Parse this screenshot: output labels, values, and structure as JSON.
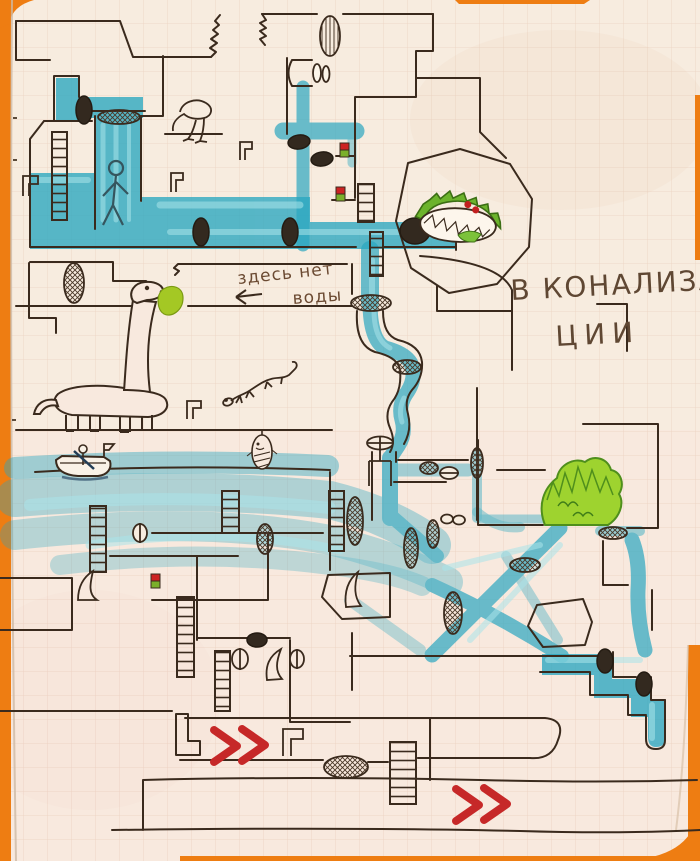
{
  "scene": {
    "type": "hand-drawn sewer level map",
    "medium": "ink and teal marker on squared notebook paper",
    "page": "graph-paper notebook with orange cover edges"
  },
  "labels": {
    "no_water": {
      "line1": "здесь нет",
      "line2": "воды"
    },
    "location": {
      "line1": "В КОНАЛИЗА-",
      "line2": "ЦИИ"
    }
  },
  "palette": {
    "paper": "#f7ecdf",
    "grid": "#dcae96",
    "ink": "#3a2a1d",
    "pencil": "#5f4733",
    "water": "#2aa7c0",
    "water_light": "#a9e3e9",
    "cover_orange": "#ee7d12",
    "accent_red": "#c62828",
    "plant_green": "#9ed32f",
    "croc_green": "#6cb32c"
  },
  "elements": [
    {
      "name": "waterfall-room",
      "desc": "flooded room with ladder, waterfall and person"
    },
    {
      "name": "dinosaur",
      "desc": "long-necked dinosaur eating a green leaf"
    },
    {
      "name": "crocodile",
      "desc": "green toothy monster inside octagonal chamber"
    },
    {
      "name": "bird",
      "desc": "small long-legged bird on a ledge"
    },
    {
      "name": "lizard",
      "desc": "small lizard"
    },
    {
      "name": "boat",
      "desc": "rowing boat with paddler on water channel"
    },
    {
      "name": "bush",
      "desc": "green spiky bush on ledge"
    },
    {
      "name": "grates",
      "desc": "hatched and dark oval sewer grates"
    },
    {
      "name": "ladders",
      "desc": "climbing ladders between tunnels"
    },
    {
      "name": "valve",
      "desc": "pipe valve with handwheel"
    },
    {
      "name": "red-chevrons",
      "desc": "double red arrows in dry tunnels"
    },
    {
      "name": "pickup-items",
      "desc": "small red-green items on ledges"
    }
  ]
}
